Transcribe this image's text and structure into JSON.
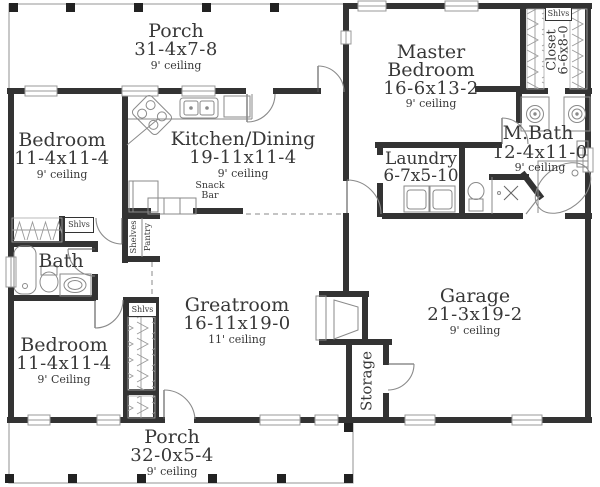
{
  "plan": {
    "porch_top": {
      "name": "Porch",
      "dims": "31-4x7-8",
      "ceiling": "9' ceiling"
    },
    "master_bedroom": {
      "name_line1": "Master",
      "name_line2": "Bedroom",
      "dims": "16-6x13-2",
      "ceiling": "9' ceiling"
    },
    "master_closet": {
      "name": "Closet",
      "dims": "6-6x8-0",
      "shelf": "Shlvs"
    },
    "bedroom_top_left": {
      "name": "Bedroom",
      "dims": "11-4x11-4",
      "ceiling": "9' ceiling",
      "shelf": "Shlvs"
    },
    "kitchen_dining": {
      "name": "Kitchen/Dining",
      "dims": "19-11x11-4",
      "ceiling": "9' ceiling",
      "snack_line1": "Snack",
      "snack_line2": "Bar"
    },
    "pantry": {
      "shelves": "Shelves",
      "pantry": "Pantry"
    },
    "laundry": {
      "name": "Laundry",
      "dims": "6-7x5-10"
    },
    "master_bath": {
      "name": "M.Bath",
      "dims": "12-4x11-0",
      "ceiling": "9' ceiling"
    },
    "bath": {
      "name": "Bath"
    },
    "greatroom": {
      "name": "Greatroom",
      "dims": "16-11x19-0",
      "ceiling": "11' ceiling"
    },
    "garage": {
      "name": "Garage",
      "dims": "21-3x19-2",
      "ceiling": "9' ceiling"
    },
    "bedroom_bottom_left": {
      "name": "Bedroom",
      "dims": "11-4x11-4",
      "ceiling": "9' Ceiling",
      "shelf": "Shlvs"
    },
    "storage": {
      "name": "Storage"
    },
    "porch_bottom": {
      "name": "Porch",
      "dims": "32-0x5-4",
      "ceiling": "9' ceiling"
    }
  }
}
